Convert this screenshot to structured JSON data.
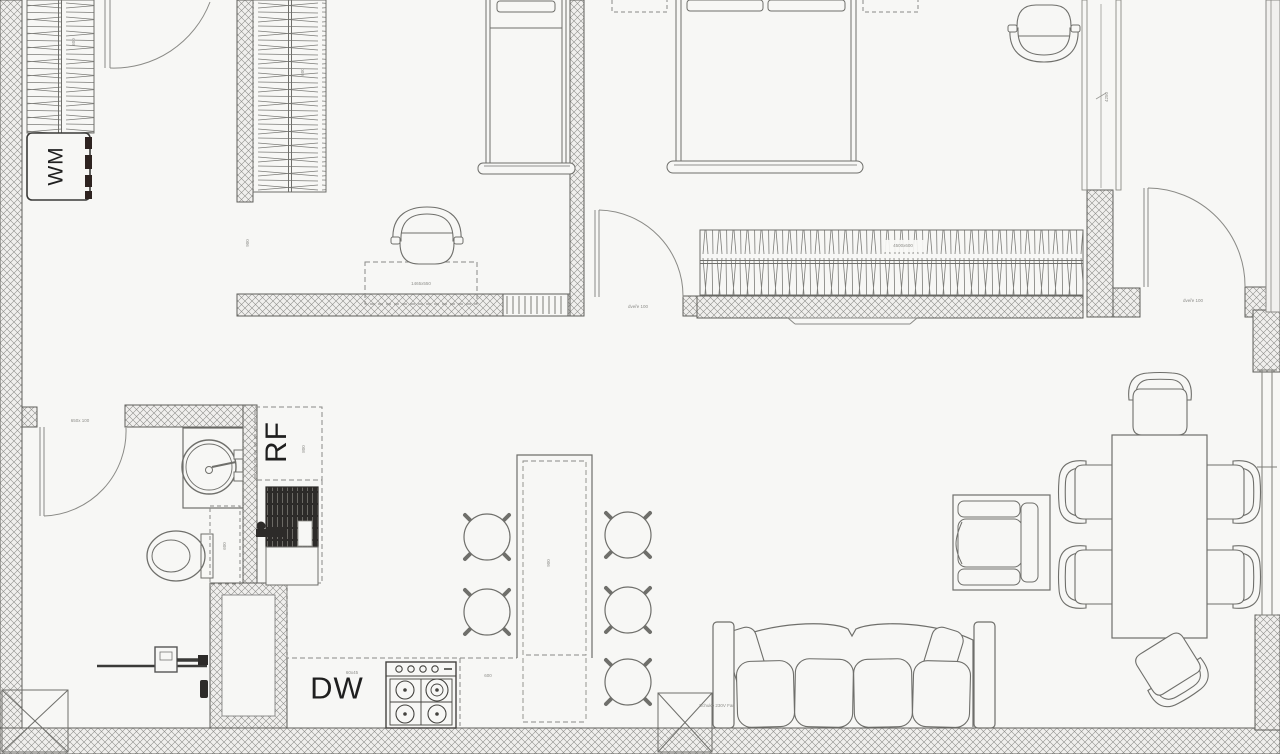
{
  "title": "apartment-floor-plan",
  "colors": {
    "background": "#f7f7f5",
    "line": "#6f6f6b",
    "wall_hatch": "#8f8f8c",
    "dark_fixture": "#2d2b29",
    "text": "#1f1f1f",
    "tiny_text": "#8e8e8a"
  },
  "labels": {
    "washing_machine": "WM",
    "refrigerator": "RF",
    "dishwasher": "DW"
  },
  "annotations": {
    "closet1_dim": "600",
    "closet2_dim": "600",
    "hall_dim": "900",
    "desk_dim": "1465x550",
    "wardrobe_dim": "4500x600",
    "bath_door_dim": "650x 100",
    "bed2_door_dim": "dveře 100",
    "entry_door_dim": "dveře 100",
    "rf_side_dim": "800",
    "island_dim": "900",
    "dw_dim": "60x45",
    "counter_dim": "600",
    "sofa_note": "Schuko 230V Fan",
    "right_wall_dim": "4250",
    "bath_cabinet_dim": "600"
  }
}
